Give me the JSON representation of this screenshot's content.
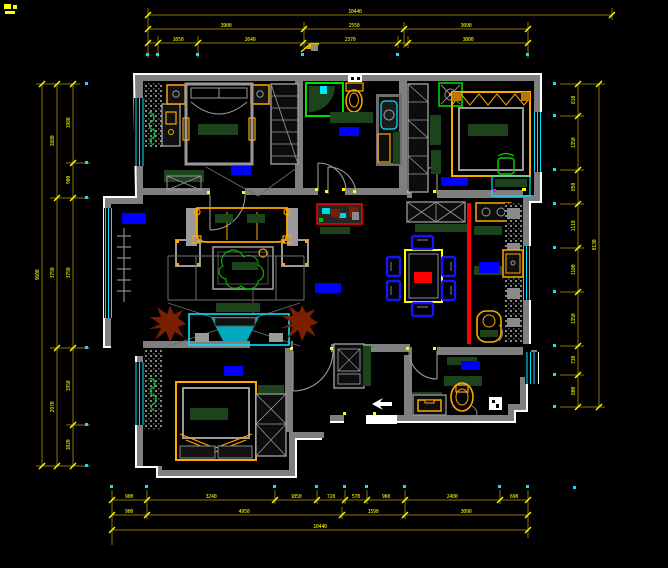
{
  "drawing": {
    "type": "CAD apartment floor plan",
    "style": "AutoCAD dark theme plan view"
  },
  "colors": {
    "background": "#000000",
    "wall": "#7f7f7f",
    "wall_outline": "#ffffff",
    "dimension_line": "#8a7400",
    "dimension_text": "#ffff00",
    "window_cyan": "#00e5ff",
    "room_label_blue": "#0000ff",
    "furniture_orange": "#ffa800",
    "furniture_dark_green": "#1d431d",
    "accent_red": "#ff0000",
    "plant_green": "#00c832",
    "plant_brown": "#7a2000",
    "chair_blue": "#1414ff"
  },
  "room_labels": [
    "bedroom-top-left",
    "bathroom",
    "bedroom-top-right",
    "living-room-bay",
    "hallway",
    "kitchen",
    "bedroom-bottom-left",
    "utility-room"
  ],
  "dims": {
    "top": {
      "total": "10440",
      "row2": [
        "3900",
        "2550",
        "3090"
      ],
      "row3": [
        "1050",
        "2640",
        "2370",
        "3000"
      ]
    },
    "bottom": {
      "row1": [
        "900",
        "3240",
        "1050",
        "720",
        "570",
        "960",
        "2400",
        "690"
      ],
      "row2": [
        "900",
        "4950",
        "1590",
        "3090"
      ],
      "total": "10440"
    },
    "left": {
      "col1": [
        "1980",
        "900",
        "3750",
        "1950",
        "1020"
      ],
      "col2": [
        "2880",
        "3750",
        "2970"
      ],
      "total": "9600"
    },
    "right": {
      "col1": [
        "810",
        "1350",
        "850",
        "1110",
        "1100",
        "1350",
        "730",
        "800"
      ],
      "total": "8130"
    }
  }
}
